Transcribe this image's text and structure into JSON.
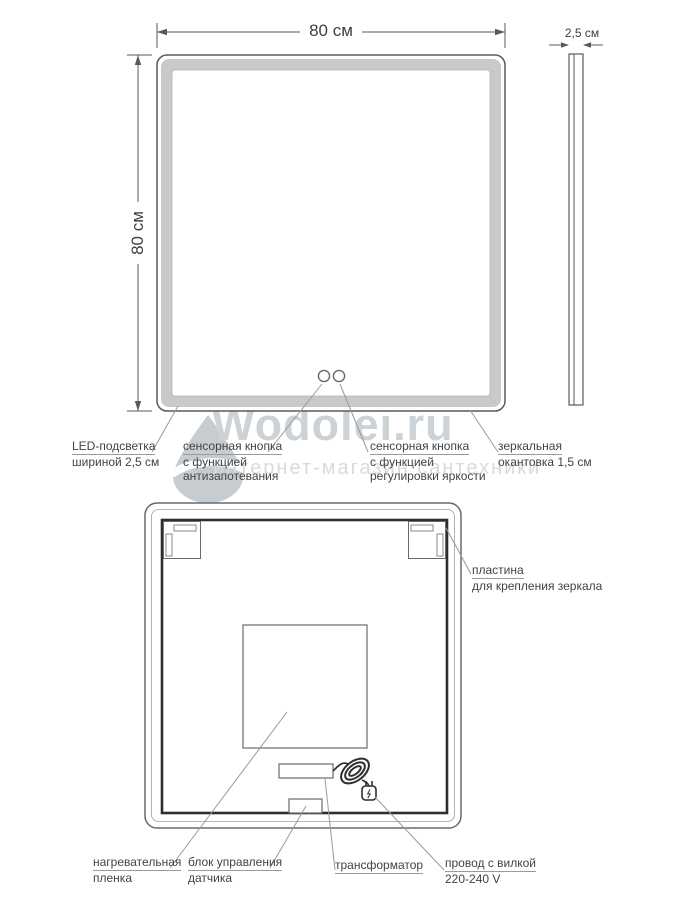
{
  "watermark": {
    "brand": "Wodolei.ru",
    "subtitle": "интернет-магазин сантехники"
  },
  "front": {
    "dim_width": "80 см",
    "dim_height": "80 см",
    "dim_depth": "2,5 см",
    "labels": {
      "led": [
        "LED-подсветка",
        "шириной 2,5 см"
      ],
      "touch_antifog": [
        "сенсорная кнопка",
        "с функцией",
        "антизапотевания"
      ],
      "touch_brightness": [
        "сенсорная кнопка",
        "с функцией",
        "регулировки яркости"
      ],
      "edge": [
        "зеркальная",
        "окантовка 1,5 см"
      ]
    }
  },
  "back": {
    "labels": {
      "plate": [
        "пластина",
        "для крепления зеркала"
      ],
      "heating": [
        "нагревательная",
        "пленка"
      ],
      "control": [
        "блок управления",
        "датчика"
      ],
      "transformer": [
        "трансформатор"
      ],
      "cord": [
        "провод с вилкой",
        "220-240 V"
      ]
    }
  },
  "colors": {
    "line": "#5a5a5a",
    "leader": "#9a9a9a",
    "dark": "#2e2e2e",
    "led": "#c9c9c9",
    "ledEdge": "#b2b2b2",
    "text": "#434343",
    "wmBrand": "#cdd2d6",
    "wmSub": "#d7dbde",
    "wmDrop": "#c6cccf"
  }
}
